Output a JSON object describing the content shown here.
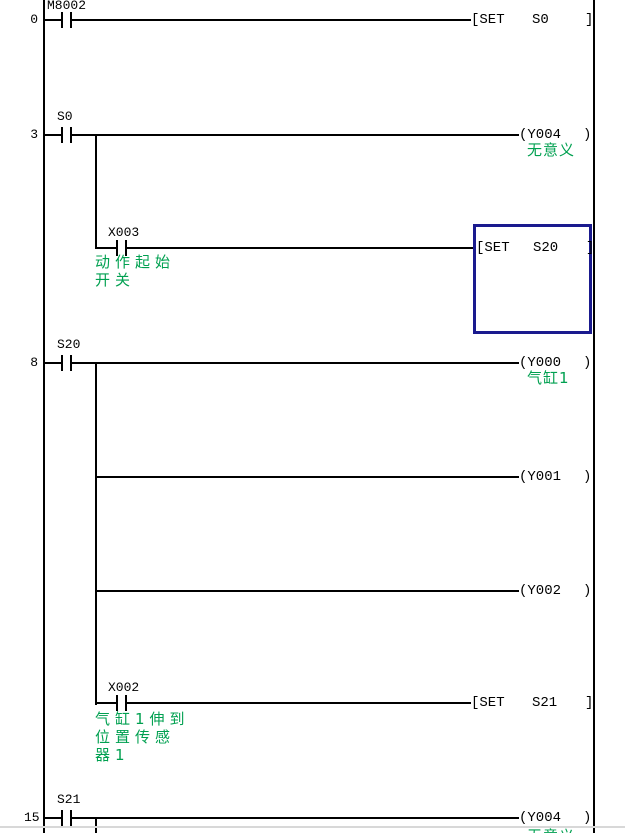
{
  "app": {
    "type": "plc-ladder-editor"
  },
  "colors": {
    "comment_green": "#00A050",
    "selection_blue": "#1A1A8E",
    "line_black": "#000000",
    "bottom_divider_gray": "#D8D8D8"
  },
  "rungs": {
    "r0": {
      "step": "0",
      "contact_label": "M8002",
      "set": {
        "op": "[SET",
        "operand": "S0",
        "close": "]"
      }
    },
    "r3": {
      "step": "3",
      "contact_label": "S0",
      "coil": {
        "open": "(Y004",
        "close": ")",
        "comment": "无意义"
      },
      "branch": {
        "contact_label": "X003",
        "comment1": "动作起始",
        "comment2": "开关",
        "set": {
          "op": "[SET",
          "operand": "S20",
          "close": "]"
        }
      }
    },
    "r8": {
      "step": "8",
      "contact_label": "S20",
      "coil1": {
        "open": "(Y000",
        "close": ")",
        "comment": "气缸1"
      },
      "coil2": {
        "open": "(Y001",
        "close": ")"
      },
      "coil3": {
        "open": "(Y002",
        "close": ")"
      },
      "branch": {
        "contact_label": "X002",
        "comment1": "气缸1伸到",
        "comment2": "位置传感",
        "comment3": "器1",
        "set": {
          "op": "[SET",
          "operand": "S21",
          "close": "]"
        }
      }
    },
    "r15": {
      "step": "15",
      "contact_label": "S21",
      "coil": {
        "open": "(Y004",
        "close": ")",
        "comment": "无意义"
      }
    }
  }
}
